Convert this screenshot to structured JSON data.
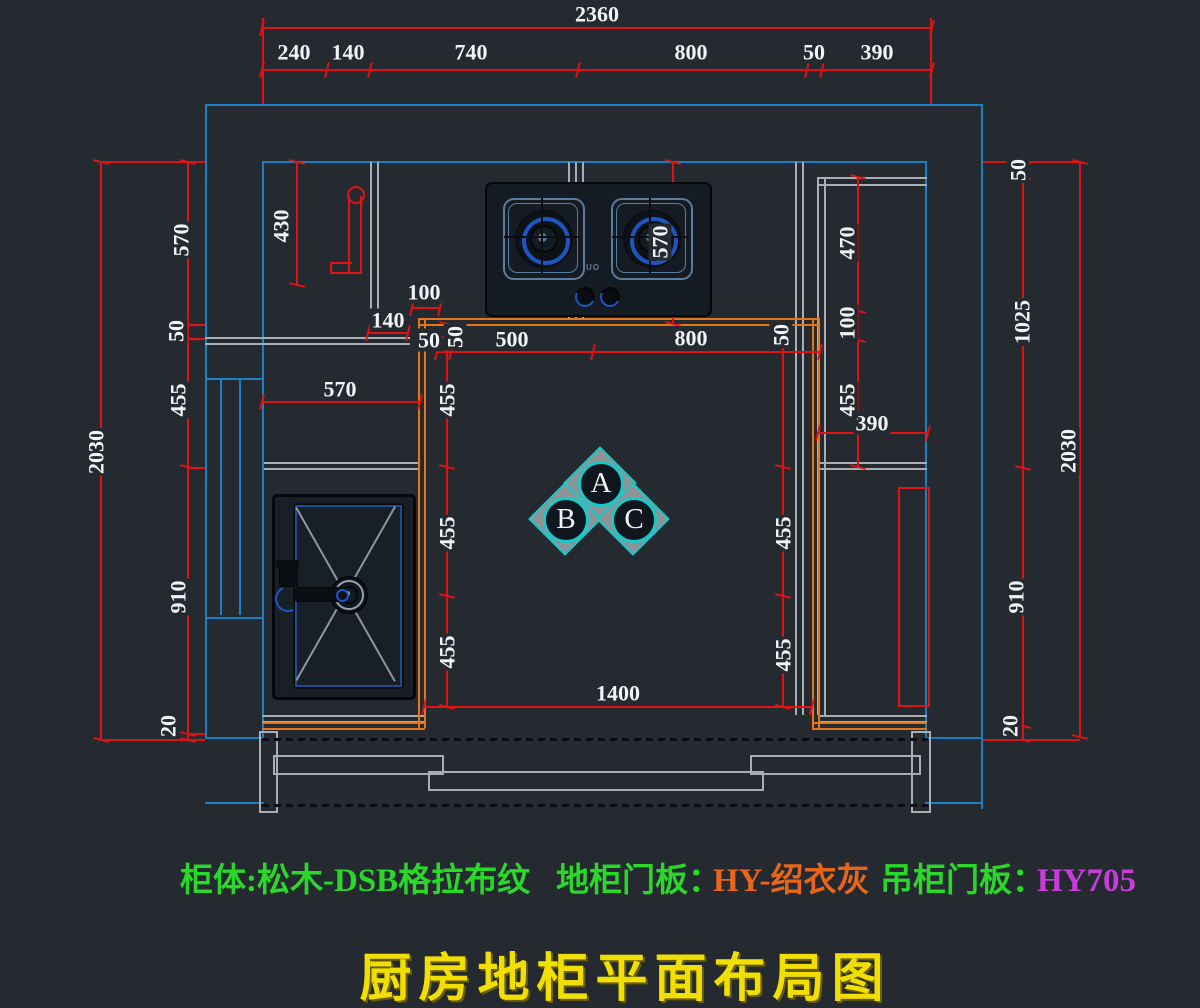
{
  "drawing": {
    "title": "厨房地柜平面布局图",
    "spec_line": {
      "segments": [
        {
          "text": "柜体:松木-DSB格拉布纹",
          "color": "#29d829"
        },
        {
          "text": "地柜门板：",
          "color": "#29d829"
        },
        {
          "text": "HY-绍衣灰",
          "color": "#e8661a"
        },
        {
          "text": "吊柜门板：",
          "color": "#29d829"
        },
        {
          "text": "HY705",
          "color": "#c73ddb"
        }
      ]
    },
    "elevation_markers": [
      "A",
      "B",
      "C"
    ],
    "stove_brand": "UO",
    "colors": {
      "background": "#252a31",
      "wall_blue": "#1d7fc3",
      "dimension_red": "#de1313",
      "counter_orange": "#e2761b",
      "cabinet_gray": "#a8aeb5",
      "marker_cyan": "#19c9c9",
      "spec_green": "#29d829",
      "spec_orange": "#e8661a",
      "spec_magenta": "#c73ddb",
      "title_yellow": "#f0df00",
      "dim_text_white": "#f2f3f4"
    },
    "dimension_chains": {
      "top_overall": "2360",
      "top_segments": [
        "240",
        "140",
        "740",
        "800",
        "50",
        "390"
      ],
      "left_overall": "2030",
      "left_segments": [
        "570",
        "50",
        "455",
        "910",
        "20"
      ],
      "right_overall": "2030",
      "right_segments": [
        "50",
        "1025",
        "910",
        "20"
      ],
      "interior_horizontal": [
        "50",
        "500",
        "800"
      ],
      "interior_left_vertical": [
        "50",
        "455",
        "455",
        "455"
      ],
      "interior_right_vertical": [
        "50",
        "455",
        "455",
        "455"
      ],
      "right_cabinet_vertical": [
        "470",
        "100",
        "455"
      ],
      "right_cabinet_width": "390",
      "left_counter_width": "570",
      "upper_left_cabinet_depth": "430",
      "stove_counter_depth": "570",
      "floor_opening_width": "1400",
      "corner_offsets": [
        "100",
        "140",
        "50"
      ]
    },
    "dim_labels": [
      {
        "t": "2360",
        "x": 597,
        "y": 14,
        "r": 0
      },
      {
        "t": "240",
        "x": 294,
        "y": 52,
        "r": 0
      },
      {
        "t": "140",
        "x": 348,
        "y": 52,
        "r": 0
      },
      {
        "t": "740",
        "x": 471,
        "y": 52,
        "r": 0
      },
      {
        "t": "800",
        "x": 691,
        "y": 52,
        "r": 0
      },
      {
        "t": "50",
        "x": 814,
        "y": 52,
        "r": 0
      },
      {
        "t": "390",
        "x": 877,
        "y": 52,
        "r": 0
      },
      {
        "t": "100",
        "x": 424,
        "y": 292,
        "r": 0
      },
      {
        "t": "140",
        "x": 388,
        "y": 320,
        "r": 0
      },
      {
        "t": "50",
        "x": 429,
        "y": 340,
        "r": 0
      },
      {
        "t": "500",
        "x": 512,
        "y": 339,
        "r": 0
      },
      {
        "t": "800",
        "x": 691,
        "y": 338,
        "r": 0
      },
      {
        "t": "570",
        "x": 340,
        "y": 389,
        "r": 0
      },
      {
        "t": "390",
        "x": 872,
        "y": 423,
        "r": 0
      },
      {
        "t": "1400",
        "x": 618,
        "y": 693,
        "r": 0
      },
      {
        "t": "2030",
        "x": 96,
        "y": 452,
        "r": 1
      },
      {
        "t": "570",
        "x": 181,
        "y": 240,
        "r": 1
      },
      {
        "t": "50",
        "x": 176,
        "y": 331,
        "r": 1
      },
      {
        "t": "455",
        "x": 178,
        "y": 400,
        "r": 1
      },
      {
        "t": "910",
        "x": 178,
        "y": 597,
        "r": 1
      },
      {
        "t": "20",
        "x": 168,
        "y": 726,
        "r": 1
      },
      {
        "t": "430",
        "x": 281,
        "y": 226,
        "r": 1
      },
      {
        "t": "570",
        "x": 660,
        "y": 242,
        "r": 1
      },
      {
        "t": "50",
        "x": 455,
        "y": 337,
        "r": 1
      },
      {
        "t": "455",
        "x": 447,
        "y": 400,
        "r": 1
      },
      {
        "t": "455",
        "x": 447,
        "y": 533,
        "r": 1
      },
      {
        "t": "455",
        "x": 447,
        "y": 652,
        "r": 1
      },
      {
        "t": "50",
        "x": 781,
        "y": 335,
        "r": 1
      },
      {
        "t": "455",
        "x": 783,
        "y": 533,
        "r": 1
      },
      {
        "t": "455",
        "x": 783,
        "y": 655,
        "r": 1
      },
      {
        "t": "470",
        "x": 847,
        "y": 243,
        "r": 1
      },
      {
        "t": "100",
        "x": 847,
        "y": 323,
        "r": 1
      },
      {
        "t": "455",
        "x": 847,
        "y": 400,
        "r": 1
      },
      {
        "t": "50",
        "x": 1018,
        "y": 170,
        "r": 1
      },
      {
        "t": "1025",
        "x": 1022,
        "y": 322,
        "r": 1
      },
      {
        "t": "910",
        "x": 1016,
        "y": 597,
        "r": 1
      },
      {
        "t": "20",
        "x": 1010,
        "y": 726,
        "r": 1
      },
      {
        "t": "2030",
        "x": 1068,
        "y": 451,
        "r": 1
      }
    ]
  }
}
